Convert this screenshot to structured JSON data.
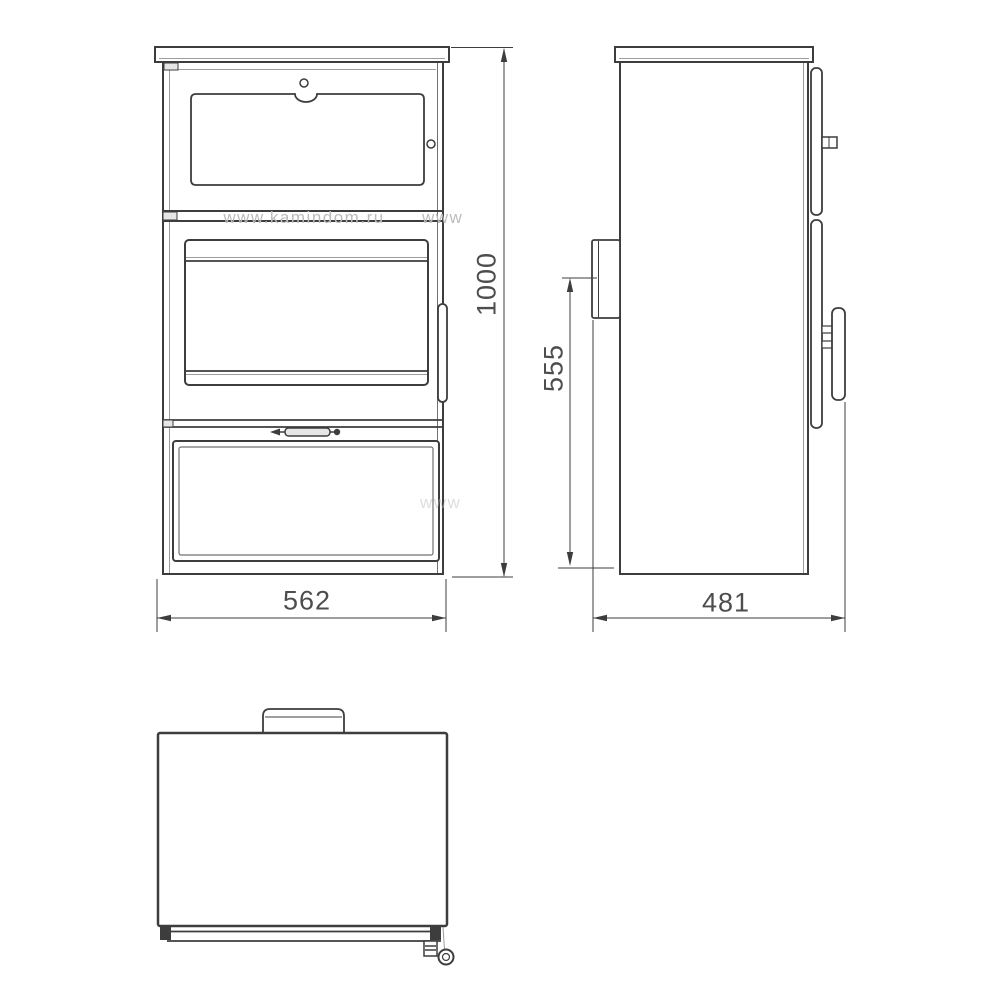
{
  "meta": {
    "background_color": "#ffffff",
    "line_color": "#3d3d3d",
    "accent_gray_color": "#9c9c9c",
    "dim_text_color": "#4d4d4d",
    "watermark_color": "#bcbcbc"
  },
  "dimensions": {
    "overall_height": "1000",
    "overall_width": "562",
    "overall_depth": "481",
    "flue_outlet_height": "555"
  },
  "watermarks": {
    "primary": "www.kamindom.ru",
    "secondary": "www",
    "tertiary": "www"
  }
}
